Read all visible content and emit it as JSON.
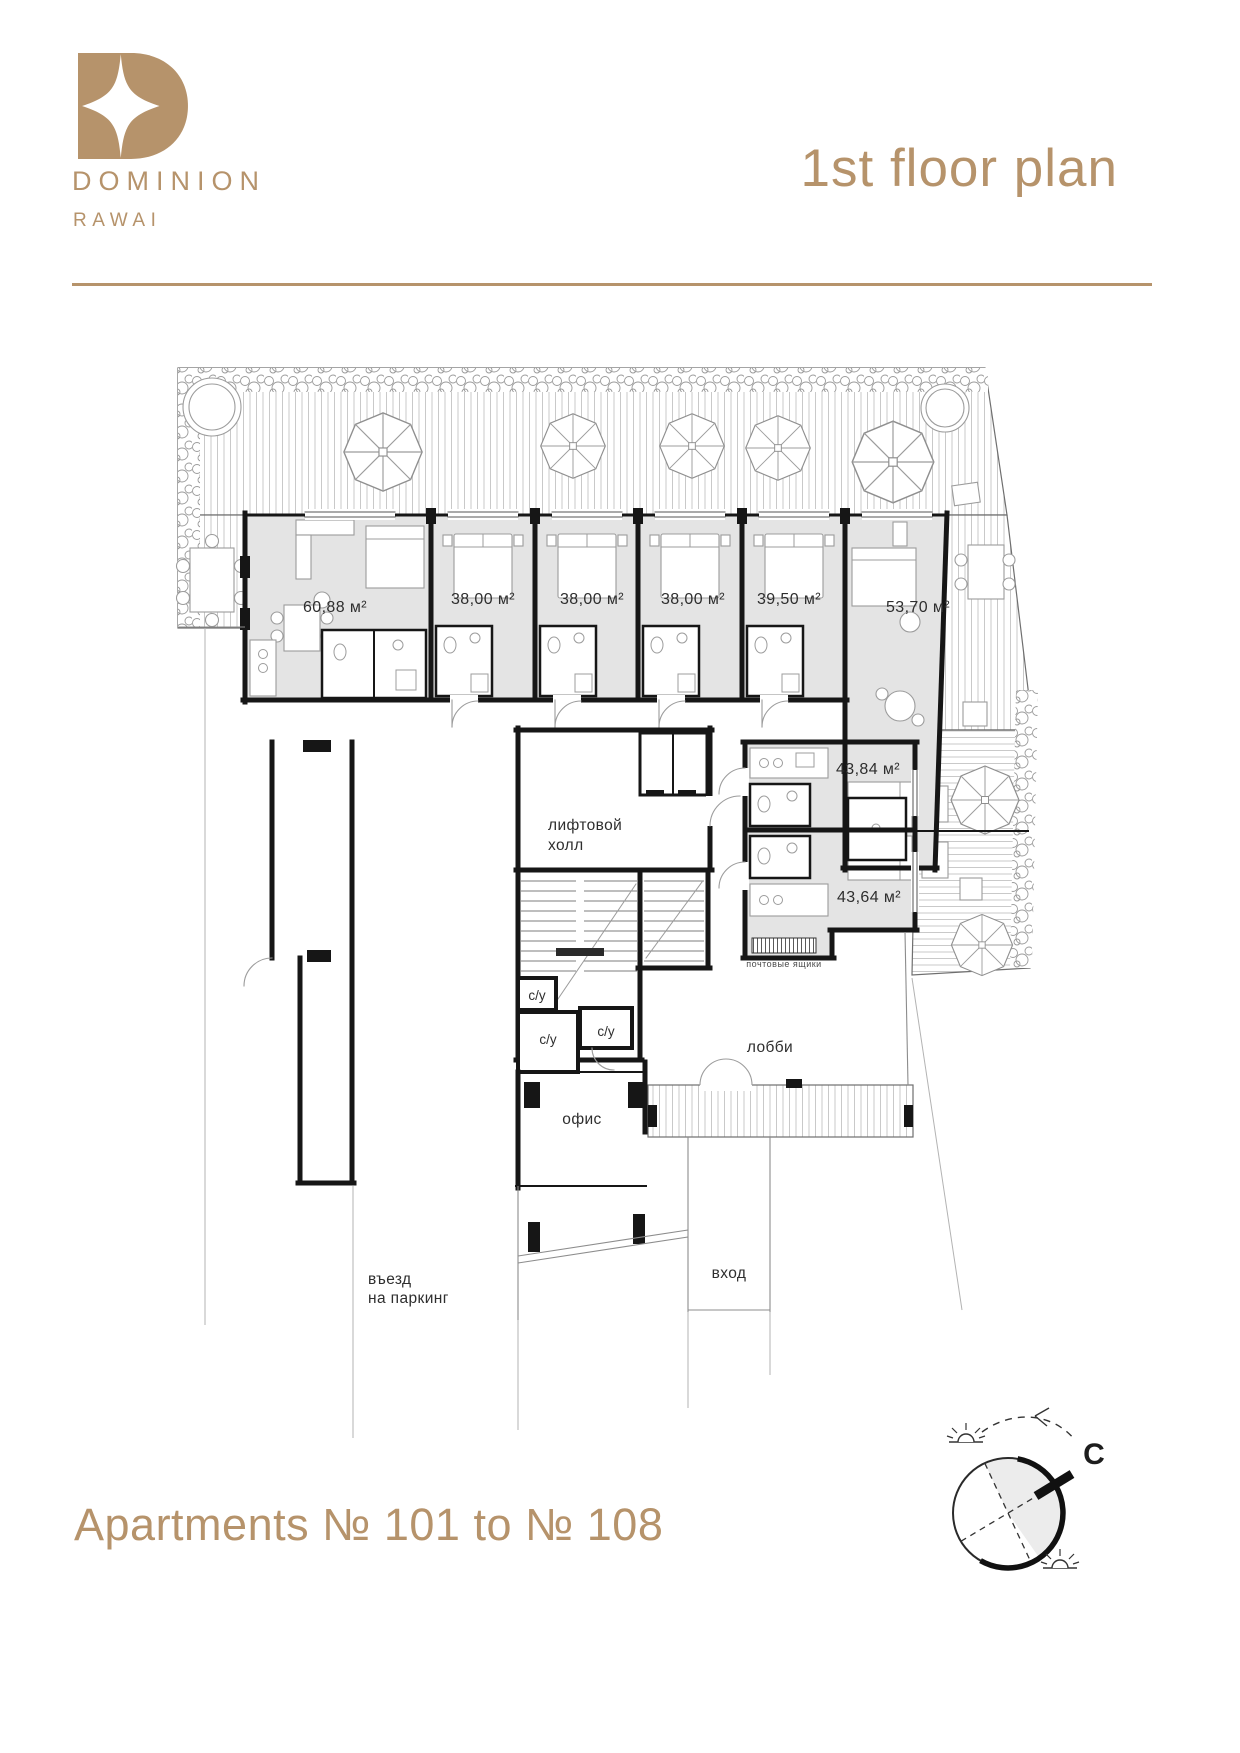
{
  "brand": {
    "logo": "dominion-monogram",
    "name": "DOMINION",
    "location": "RAWAI"
  },
  "header": {
    "title": "1st floor plan"
  },
  "plan": {
    "unit_areas": [
      "60,88 м²",
      "38,00 м²",
      "38,00 м²",
      "38,00 м²",
      "39,50 м²",
      "53,70 м²",
      "43,84 м²",
      "43,64 м²"
    ],
    "rooms": {
      "elevator_hall_line1": "лифтовой",
      "elevator_hall_line2": "холл",
      "wc": "с/у",
      "lobby": "лобби",
      "office": "офис",
      "mailboxes": "почтовые ящики",
      "entrance": "вход",
      "parking_line1": "въезд",
      "parking_line2": "на паркинг"
    },
    "compass_north": "C"
  },
  "footer": {
    "caption": "Apartments № 101 to № 108"
  },
  "colors": {
    "gold": "#b6936b",
    "ink": "#161616",
    "unit_fill": "#e4e4e4"
  }
}
